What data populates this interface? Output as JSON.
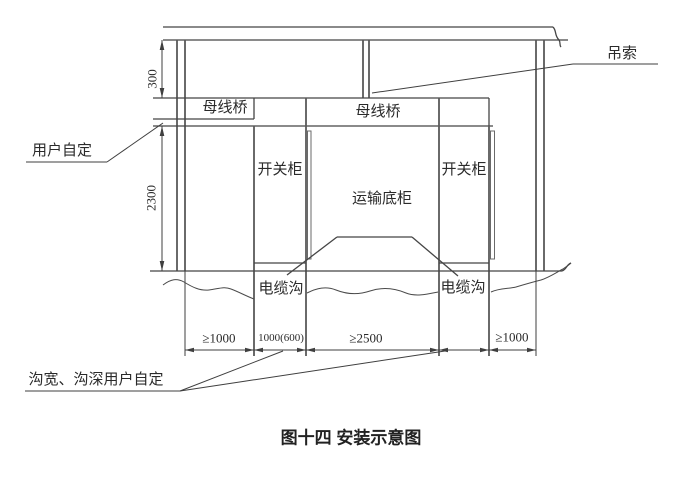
{
  "page": {
    "background": "#ffffff",
    "line_color": "#3f3f3f",
    "text_color": "#2a2a2a"
  },
  "figure_title": "图十四 安装示意图",
  "labels": {
    "sling": "吊索",
    "busbar_bridge_left": "母线桥",
    "busbar_bridge_center": "母线桥",
    "switch_cabinet_left": "开关柜",
    "switch_cabinet_right": "开关柜",
    "transport_base_cabinet": "运输底柜",
    "cable_trench_left": "电缆沟",
    "cable_trench_right": "电缆沟",
    "user_defined_gap": "用户自定",
    "trench_note": "沟宽、沟深用户自定"
  },
  "dimensions": {
    "busbar_to_ceiling": "300",
    "cabinet_height": "2300",
    "left_side_clearance": "≥1000",
    "left_trench_width": "1000(600)",
    "front_clearance": "≥2500",
    "right_side_clearance": "≥1000"
  }
}
